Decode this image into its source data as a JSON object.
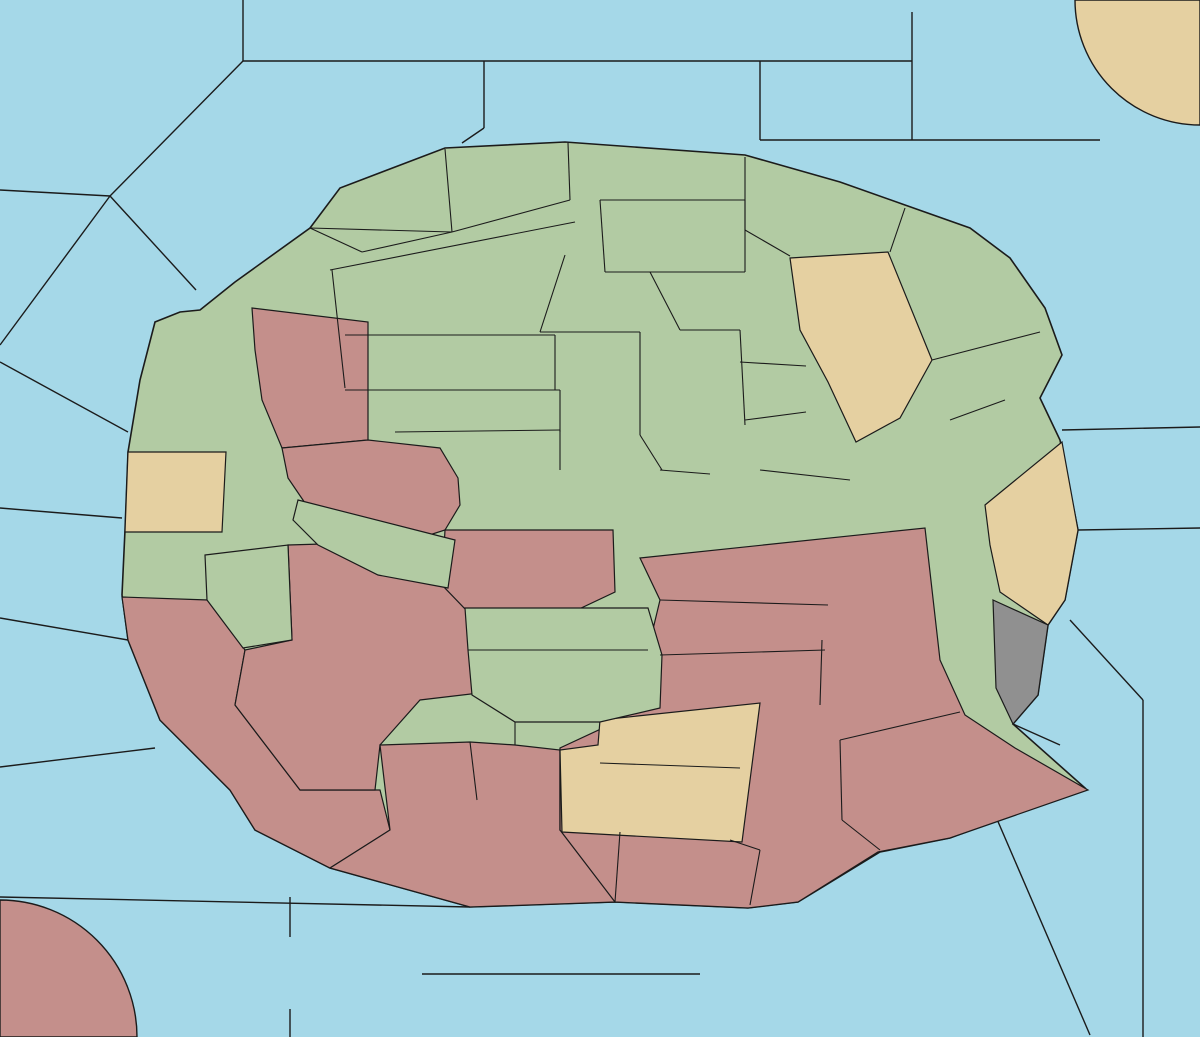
{
  "map": {
    "colors": {
      "sea": "#A5D8E8",
      "land_green": "#B2CBA3",
      "land_pink": "#C48F8B",
      "land_tan": "#E5D0A1",
      "land_gray": "#909090",
      "border": "#1b1b1b",
      "arrow_red": "#C8270B",
      "arrow_yellow": "#FFE93A",
      "arrow_green": "#3FCE13",
      "arrow_magenta": "#C72FC7",
      "arrow_black": "#000000",
      "highlight_blue": "#3F7BD0",
      "explosion_orange": "#FF9017"
    },
    "sea_labels": [
      {
        "text": "Polarmeer",
        "x": 417,
        "y": 38
      },
      {
        "text": "Nordwestmeer",
        "x": 75,
        "y": 137
      },
      {
        "text": "Fungali-Meer",
        "x": 240,
        "y": 178
      },
      {
        "text": "Cobaltmeer",
        "x": 561,
        "y": 103
      },
      {
        "text": "Nordostmeer",
        "x": 1035,
        "y": 116
      },
      {
        "text": "Ozean von Doom",
        "x": 1084,
        "y": 232
      },
      {
        "text": "Kaltes Meer",
        "x": 62,
        "y": 370,
        "lines": [
          "Kaltes",
          "Meer"
        ]
      },
      {
        "text": "Golf von Gawan",
        "x": 112,
        "y": 328,
        "lines": [
          "Golf von",
          "Gawan"
        ]
      },
      {
        "text": "Meer von Uuz",
        "x": 100,
        "y": 407,
        "lines": [
          "Meer",
          "von Uuz"
        ]
      },
      {
        "text": "Gorkion delta",
        "x": 233,
        "y": 394,
        "lines": [
          "Gorkion",
          "delta"
        ]
      },
      {
        "text": "Mittel-gorkion",
        "x": 277,
        "y": 525,
        "lines": [
          "Mittel-",
          "gorkion"
        ]
      },
      {
        "text": "Rotbucht",
        "x": 339,
        "y": 633
      },
      {
        "text": "Borkmeer",
        "x": 58,
        "y": 602
      },
      {
        "text": "Doringkanal",
        "x": 81,
        "y": 750
      },
      {
        "text": "Golf von Ailea",
        "x": 118,
        "y": 876
      },
      {
        "text": "Suedwestmeer",
        "x": 166,
        "y": 942
      },
      {
        "text": "Corws",
        "x": 47,
        "y": 1018
      },
      {
        "text": "Lithiumsee",
        "x": 520,
        "y": 963
      },
      {
        "text": "Daxmeer",
        "x": 577,
        "y": 1015
      },
      {
        "text": "Froidevaux-Meer",
        "x": 838,
        "y": 944
      },
      {
        "text": "Suedostmeer",
        "x": 1074,
        "y": 1002
      },
      {
        "text": "Golf von Pirh",
        "x": 1088,
        "y": 779
      },
      {
        "text": "Altes Meer",
        "x": 1167,
        "y": 702,
        "lines": [
          "Altes",
          "Meer"
        ]
      },
      {
        "text": "Kupfer-Küste",
        "x": 1104,
        "y": 615,
        "lines": [
          "Kupfer-",
          "Küste"
        ]
      },
      {
        "text": "Rodesion Delta",
        "x": 967,
        "y": 636,
        "lines": [
          "Rodesion",
          "Delta"
        ]
      },
      {
        "text": "Smaragd-Bucht",
        "x": 862,
        "y": 408,
        "lines": [
          "Smaragd-",
          "Bucht"
        ]
      },
      {
        "text": "Bucht des Ostens",
        "x": 933,
        "y": 510,
        "lines": [
          "Bucht",
          "des",
          "Ostens"
        ]
      },
      {
        "text": "Kamalastrasse",
        "x": 1139,
        "y": 385
      },
      {
        "text": "Teisee",
        "x": 1137,
        "y": 492
      },
      {
        "text": "Conno",
        "x": 1152,
        "y": 81
      }
    ],
    "land_labels": [
      {
        "text": "Jadestadt",
        "x": 506,
        "y": 183
      },
      {
        "text": "Schloss Gruenburg",
        "x": 648,
        "y": 185
      },
      {
        "text": "Qualinost",
        "x": 378,
        "y": 213
      },
      {
        "text": "Jossangia",
        "x": 446,
        "y": 253
      },
      {
        "text": "Gruenheim",
        "x": 658,
        "y": 228
      },
      {
        "text": "Eld",
        "x": 869,
        "y": 237
      },
      {
        "text": "Caraveccia",
        "x": 784,
        "y": 279
      },
      {
        "text": "Yokai",
        "x": 713,
        "y": 299
      },
      {
        "text": "Elchen",
        "x": 447,
        "y": 311
      },
      {
        "text": "Nari",
        "x": 574,
        "y": 335
      },
      {
        "text": "Utar",
        "x": 872,
        "y": 325
      },
      {
        "text": "Kath",
        "x": 966,
        "y": 327
      },
      {
        "text": "Candolti",
        "x": 299,
        "y": 303
      },
      {
        "text": "Tel",
        "x": 397,
        "y": 365
      },
      {
        "text": "Olk",
        "x": 573,
        "y": 375
      },
      {
        "text": "Riesenheim",
        "x": 1010,
        "y": 376
      },
      {
        "text": "Land der Wiesel",
        "x": 437,
        "y": 416
      },
      {
        "text": "Hugl",
        "x": 703,
        "y": 415
      },
      {
        "text": "Amphi",
        "x": 770,
        "y": 394
      },
      {
        "text": "Esmaladan",
        "x": 782,
        "y": 430
      },
      {
        "text": "Bridon",
        "x": 954,
        "y": 423
      },
      {
        "text": "Gawar",
        "x": 182,
        "y": 401
      },
      {
        "text": "Gurand",
        "x": 322,
        "y": 420
      },
      {
        "text": "Norterend",
        "x": 495,
        "y": 461
      },
      {
        "text": "Wildall",
        "x": 619,
        "y": 463
      },
      {
        "text": "Skr",
        "x": 559,
        "y": 497
      },
      {
        "text": "Ostberg",
        "x": 644,
        "y": 502
      },
      {
        "text": "Mellar",
        "x": 788,
        "y": 502
      },
      {
        "text": "Westberg",
        "x": 535,
        "y": 548
      },
      {
        "text": "Hills",
        "x": 491,
        "y": 585
      },
      {
        "text": "Eun",
        "x": 637,
        "y": 580
      },
      {
        "text": "Sund",
        "x": 709,
        "y": 581
      },
      {
        "text": "Heronn",
        "x": 160,
        "y": 484
      },
      {
        "text": "Saphirschlucht",
        "x": 364,
        "y": 509
      },
      {
        "text": "Korbia",
        "x": 175,
        "y": 556
      },
      {
        "text": "Nabai",
        "x": 363,
        "y": 580
      },
      {
        "text": "Nogk",
        "x": 435,
        "y": 596
      },
      {
        "text": "Obstschlucht",
        "x": 834,
        "y": 545
      },
      {
        "text": "Bynn",
        "x": 1014,
        "y": 540
      },
      {
        "text": "Gwaul",
        "x": 1010,
        "y": 569
      },
      {
        "text": "Arkoon",
        "x": 243,
        "y": 635
      },
      {
        "text": "Verlorenes Land",
        "x": 182,
        "y": 663,
        "lines": [
          "Verlorenes",
          "Land"
        ]
      },
      {
        "text": "Barana",
        "x": 430,
        "y": 654
      },
      {
        "text": "Urur",
        "x": 495,
        "y": 631
      },
      {
        "text": "Feuerfeld",
        "x": 779,
        "y": 636
      },
      {
        "text": "Chapablublek",
        "x": 525,
        "y": 678
      },
      {
        "text": "Neu Rom",
        "x": 700,
        "y": 684
      },
      {
        "text": "Orlon",
        "x": 888,
        "y": 704
      },
      {
        "text": "Pirh",
        "x": 1020,
        "y": 690
      },
      {
        "text": "Charaua",
        "x": 323,
        "y": 729
      },
      {
        "text": "Qwil",
        "x": 458,
        "y": 733
      },
      {
        "text": "Kentommenai",
        "x": 257,
        "y": 769
      },
      {
        "text": "Nilldall",
        "x": 577,
        "y": 752
      },
      {
        "text": "Kaaldewaa",
        "x": 659,
        "y": 768
      },
      {
        "text": "Sottovia",
        "x": 420,
        "y": 806
      },
      {
        "text": "Rotheim",
        "x": 508,
        "y": 826
      },
      {
        "text": "Mouchimoglou",
        "x": 691,
        "y": 828
      },
      {
        "text": "Losteria",
        "x": 884,
        "y": 798
      },
      {
        "text": "Ailea",
        "x": 341,
        "y": 853
      },
      {
        "text": "Samyria",
        "x": 805,
        "y": 863
      },
      {
        "text": "Zinnoberburg",
        "x": 446,
        "y": 874
      },
      {
        "text": "Karminstadt",
        "x": 692,
        "y": 892
      },
      {
        "text": "Abaun",
        "x": 290,
        "y": 995
      },
      {
        "text": "Ornheim",
        "x": 378,
        "y": 995
      },
      {
        "text": "Elfland",
        "x": 822,
        "y": 90
      },
      {
        "text": "Helom",
        "x": 913,
        "y": 90
      }
    ],
    "coast_labels": [
      {
        "text": "(wc)",
        "x": 136,
        "y": 424
      },
      {
        "text": "(ec)",
        "x": 206,
        "y": 485
      },
      {
        "text": "(ec)",
        "x": 222,
        "y": 536
      },
      {
        "text": "(wc)",
        "x": 137,
        "y": 578
      },
      {
        "text": "(ec)",
        "x": 1057,
        "y": 470
      },
      {
        "text": "(wc)",
        "x": 985,
        "y": 542
      },
      {
        "text": "(wc)",
        "x": 998,
        "y": 590
      },
      {
        "text": "(ec)",
        "x": 1047,
        "y": 625
      }
    ],
    "supply_centers": [
      [
        448,
        157
      ],
      [
        627,
        155
      ],
      [
        941,
        41
      ],
      [
        1186,
        13
      ],
      [
        696,
        250
      ],
      [
        518,
        363
      ],
      [
        732,
        332
      ],
      [
        1008,
        334
      ],
      [
        258,
        272
      ],
      [
        198,
        426
      ],
      [
        503,
        494
      ],
      [
        690,
        540
      ],
      [
        683,
        589
      ],
      [
        752,
        492
      ],
      [
        873,
        431
      ],
      [
        973,
        481
      ],
      [
        1002,
        607
      ],
      [
        813,
        677
      ],
      [
        948,
        762
      ],
      [
        743,
        870
      ],
      [
        572,
        881
      ],
      [
        460,
        696
      ],
      [
        494,
        779
      ],
      [
        188,
        708
      ],
      [
        8,
        1025
      ],
      [
        255,
        952
      ],
      [
        230,
        563
      ],
      [
        422,
        449
      ],
      [
        423,
        547
      ]
    ],
    "units": [
      {
        "type": "army",
        "region": "Nari",
        "x": 617,
        "y": 307
      },
      {
        "type": "army",
        "region": "Skr",
        "x": 560,
        "y": 468
      },
      {
        "type": "army",
        "region": "Westberg",
        "x": 516,
        "y": 524
      },
      {
        "type": "army",
        "region": "Wildall",
        "x": 672,
        "y": 456
      },
      {
        "type": "army",
        "region": "Ostberg",
        "x": 676,
        "y": 523
      },
      {
        "type": "army",
        "region": "Eun",
        "x": 634,
        "y": 550
      },
      {
        "type": "army",
        "region": "Hills",
        "x": 534,
        "y": 576
      },
      {
        "type": "army",
        "region": "Mellar",
        "x": 832,
        "y": 477
      },
      {
        "type": "army",
        "region": "Obstschlucht",
        "x": 869,
        "y": 564
      },
      {
        "type": "army",
        "region": "Korbia",
        "x": 169,
        "y": 528
      },
      {
        "type": "army",
        "region": "Arkoon",
        "x": 235,
        "y": 599
      },
      {
        "type": "army",
        "region": "Verlorenes Land",
        "x": 172,
        "y": 630
      },
      {
        "type": "army",
        "region": "Chapablublek",
        "x": 516,
        "y": 691
      },
      {
        "type": "army",
        "region": "Qwil",
        "x": 487,
        "y": 747
      },
      {
        "type": "army",
        "region": "Sottovia",
        "x": 419,
        "y": 775
      },
      {
        "type": "army",
        "region": "Pirh",
        "x": 1019,
        "y": 662
      },
      {
        "type": "army",
        "region": "Nabai",
        "x": 354,
        "y": 552
      },
      {
        "type": "fleet",
        "region": "Cobaltmeer",
        "x": 652,
        "y": 102
      },
      {
        "type": "fleet",
        "region": "Ozean von Doom",
        "x": 1029,
        "y": 196
      },
      {
        "type": "fleet",
        "region": "Helom",
        "x": 917,
        "y": 62
      },
      {
        "type": "fleet",
        "region": "Gawar",
        "x": 174,
        "y": 377
      },
      {
        "type": "fleet",
        "region": "Mittel-gorkion",
        "x": 262,
        "y": 497
      },
      {
        "type": "fleet",
        "region": "Saphirschlucht",
        "x": 326,
        "y": 477
      },
      {
        "type": "fleet",
        "region": "Rotbucht",
        "x": 315,
        "y": 599
      },
      {
        "type": "fleet",
        "region": "Bridon",
        "x": 964,
        "y": 461,
        "highlighted": true
      },
      {
        "type": "fleet",
        "region": "Abaun",
        "x": 287,
        "y": 969
      }
    ],
    "unit_boxes": [
      {
        "x": 640,
        "y": 79,
        "w": 26,
        "h": 25,
        "fill": "green"
      },
      {
        "x": 1016,
        "y": 177,
        "w": 27,
        "h": 28,
        "fill": "green"
      },
      {
        "x": 250,
        "y": 476,
        "w": 25,
        "h": 29,
        "fill": "green"
      },
      {
        "x": 342,
        "y": 531,
        "w": 26,
        "h": 30,
        "fill": "pink"
      },
      {
        "x": 222,
        "y": 582,
        "w": 27,
        "h": 31,
        "fill": "pink"
      },
      {
        "x": 302,
        "y": 582,
        "w": 27,
        "h": 31,
        "fill": "green"
      }
    ],
    "legend_islands": [
      {
        "name": "Elfland",
        "x": 779,
        "y": 28,
        "w": 89,
        "h": 70,
        "fill": "tan"
      },
      {
        "name": "Helom",
        "x": 868,
        "y": 28,
        "w": 90,
        "h": 70,
        "fill": "gray"
      },
      {
        "name": "Abaun",
        "x": 243,
        "y": 937,
        "w": 90,
        "h": 72,
        "fill": "gray"
      },
      {
        "name": "Ornheim",
        "x": 333,
        "y": 937,
        "w": 89,
        "h": 72,
        "fill": "tan"
      }
    ],
    "orders": {
      "red_arrows": [
        [
          512,
          161,
          646,
          103
        ],
        [
          620,
          134,
          643,
          109
        ],
        [
          662,
          156,
          1018,
          192
        ],
        [
          642,
          231,
          620,
          299
        ],
        [
          226,
          369,
          250,
          468
        ],
        [
          320,
          420,
          266,
          478
        ],
        [
          322,
          592,
          346,
          562
        ],
        [
          412,
          606,
          369,
          564
        ],
        [
          390,
          587,
          362,
          559
        ],
        [
          312,
          694,
          249,
          618
        ],
        [
          284,
          652,
          242,
          608
        ],
        [
          672,
          468,
          674,
          514
        ],
        [
          534,
          568,
          525,
          542
        ],
        [
          836,
          490,
          858,
          546
        ],
        [
          867,
          558,
          849,
          517
        ],
        [
          577,
          628,
          524,
          686
        ],
        [
          320,
          822,
          406,
          779
        ],
        [
          382,
          799,
          476,
          752
        ]
      ],
      "yellow_arrows": [
        [
          181,
          388,
          246,
          466
        ],
        [
          193,
          414,
          242,
          460
        ],
        [
          329,
          489,
          349,
          538
        ],
        [
          341,
          489,
          357,
          532
        ],
        [
          196,
          620,
          228,
          613
        ],
        [
          197,
          643,
          229,
          623
        ],
        [
          200,
          632,
          232,
          618
        ],
        [
          621,
          548,
          577,
          542
        ],
        [
          612,
          560,
          579,
          549
        ],
        [
          656,
          499,
          596,
          504
        ],
        [
          649,
          507,
          534,
          521
        ]
      ],
      "green_arrows": [
        [
          548,
          473,
          519,
          526
        ],
        [
          506,
          501,
          540,
          527
        ]
      ],
      "magenta_arrows": [
        [
          186,
          577,
          178,
          541
        ],
        [
          222,
          587,
          204,
          544
        ]
      ],
      "black_double_arrows": [
        [
          200,
          337,
          244,
          337
        ],
        [
          253,
          553,
          310,
          553
        ],
        [
          818,
          407,
          843,
          384
        ],
        [
          358,
          651,
          380,
          629
        ],
        [
          890,
          481,
          947,
          481
        ],
        [
          961,
          698,
          991,
          698
        ]
      ],
      "fail_marks": [
        [
          670,
          478
        ],
        [
          568,
          515
        ],
        [
          529,
          560
        ],
        [
          845,
          506
        ],
        [
          855,
          538
        ]
      ],
      "explosions": [
        [
          248,
          594
        ]
      ],
      "highlighted_unit": [
        964,
        460
      ]
    }
  }
}
